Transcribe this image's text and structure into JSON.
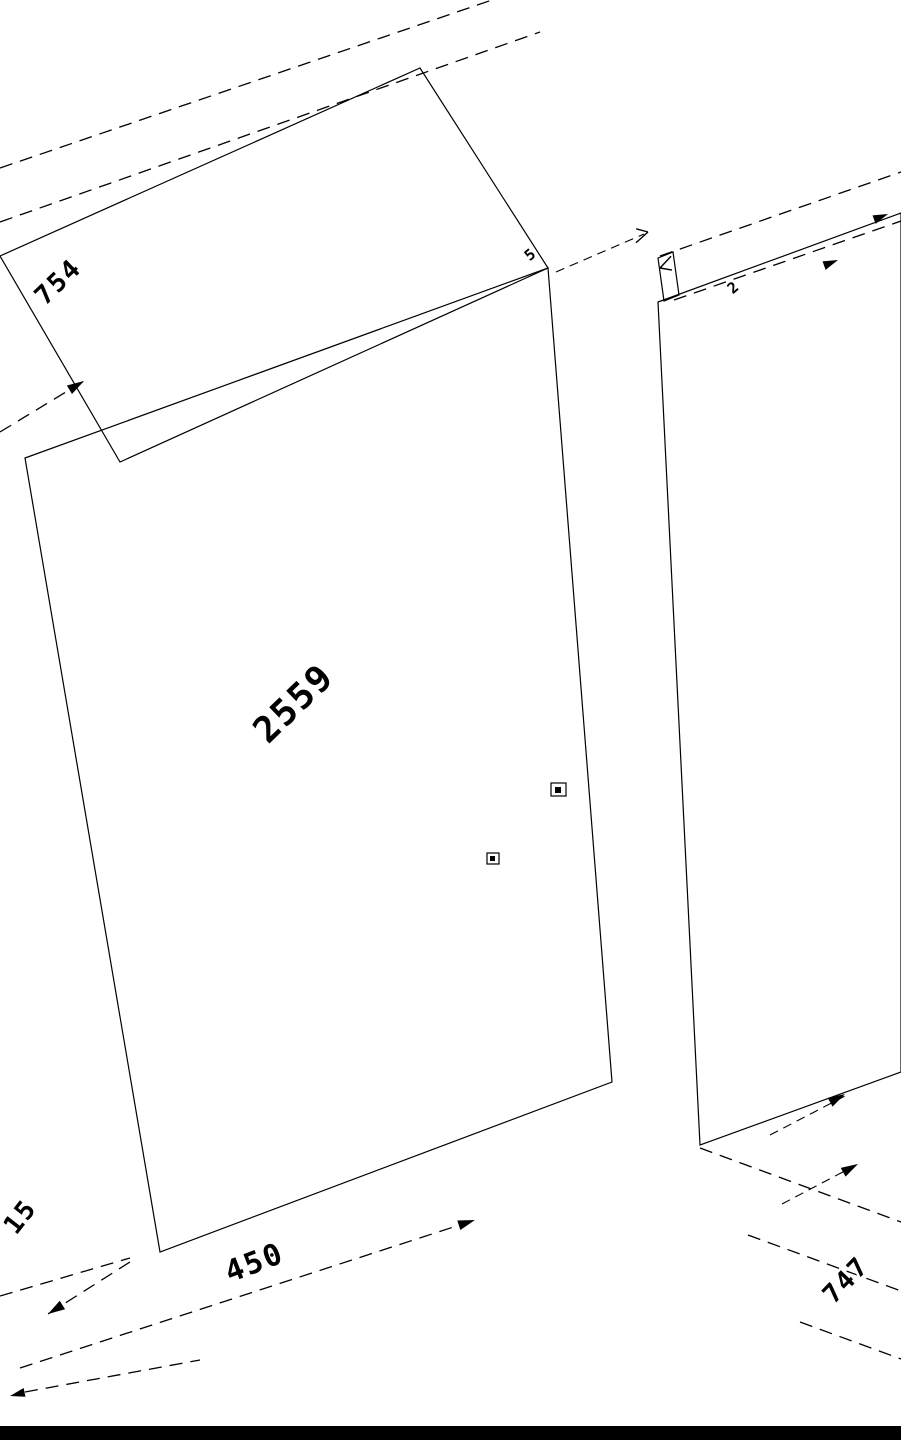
{
  "drawing": {
    "title": "isometric-cad-drawing-of-wardrobe-panels",
    "dimensions": {
      "top_panel_depth": "754",
      "top_thickness_left": "5",
      "top_thickness_right": "2",
      "front_width": "2559",
      "base_depth": "450",
      "plinth_height": "15",
      "side_panel_depth": "747"
    },
    "colors": {
      "line": "#000000",
      "background": "#ffffff",
      "footer_bar": "#000000"
    }
  }
}
